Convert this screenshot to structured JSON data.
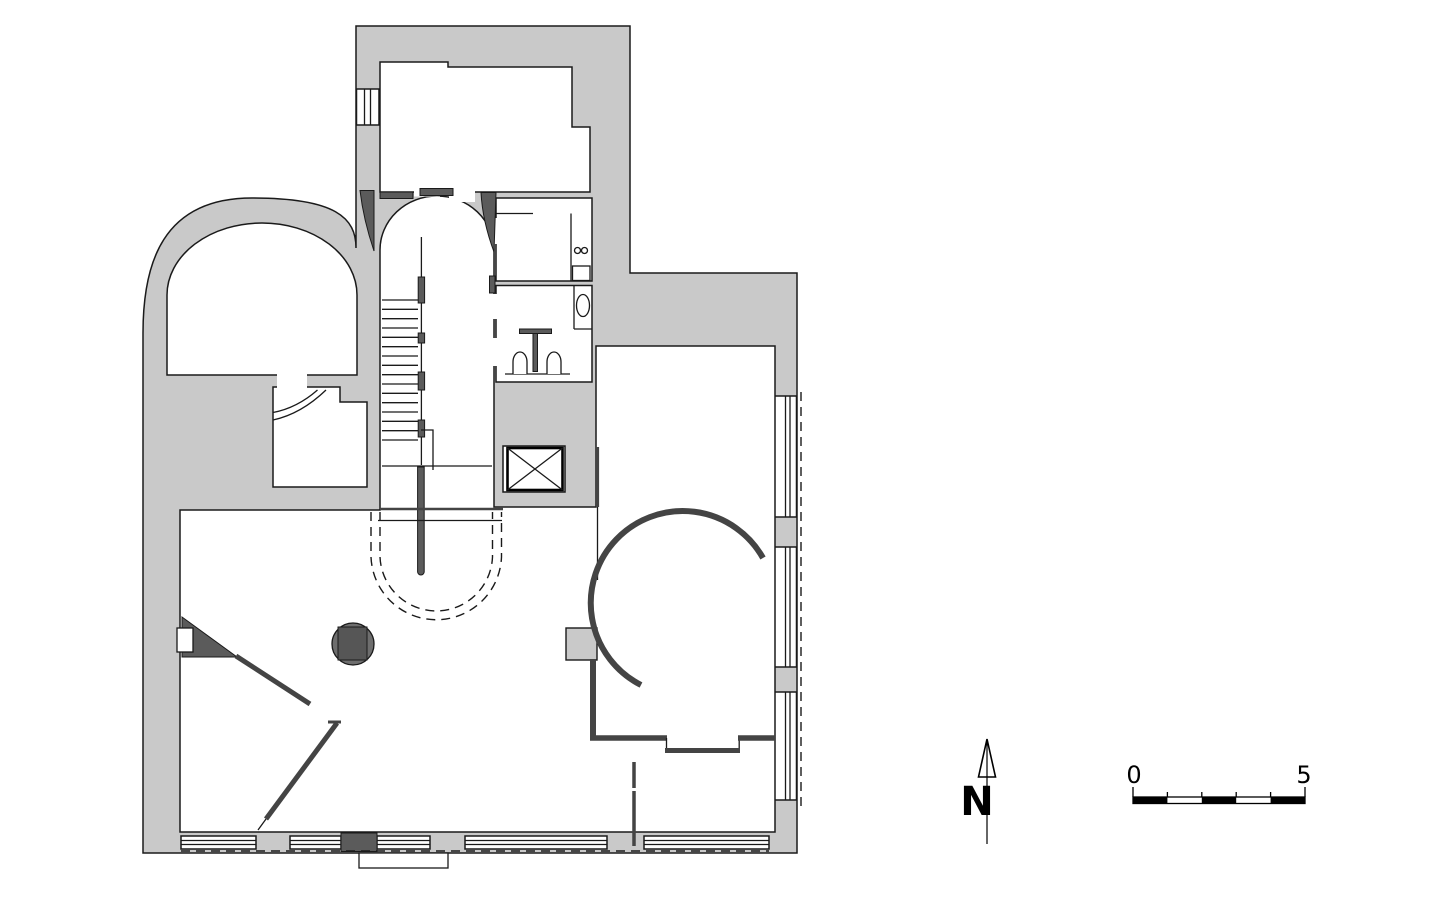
{
  "document": {
    "type": "architectural-floor-plan",
    "background": "#ffffff",
    "colors": {
      "poche_gray": "#c9c9c9",
      "dark_gray": "#5b5b5b",
      "line_black": "#1a1a1a"
    }
  },
  "compass": {
    "label": "N"
  },
  "scale_bar": {
    "zero_label": "0",
    "five_label": "5",
    "segment_count": 5
  }
}
